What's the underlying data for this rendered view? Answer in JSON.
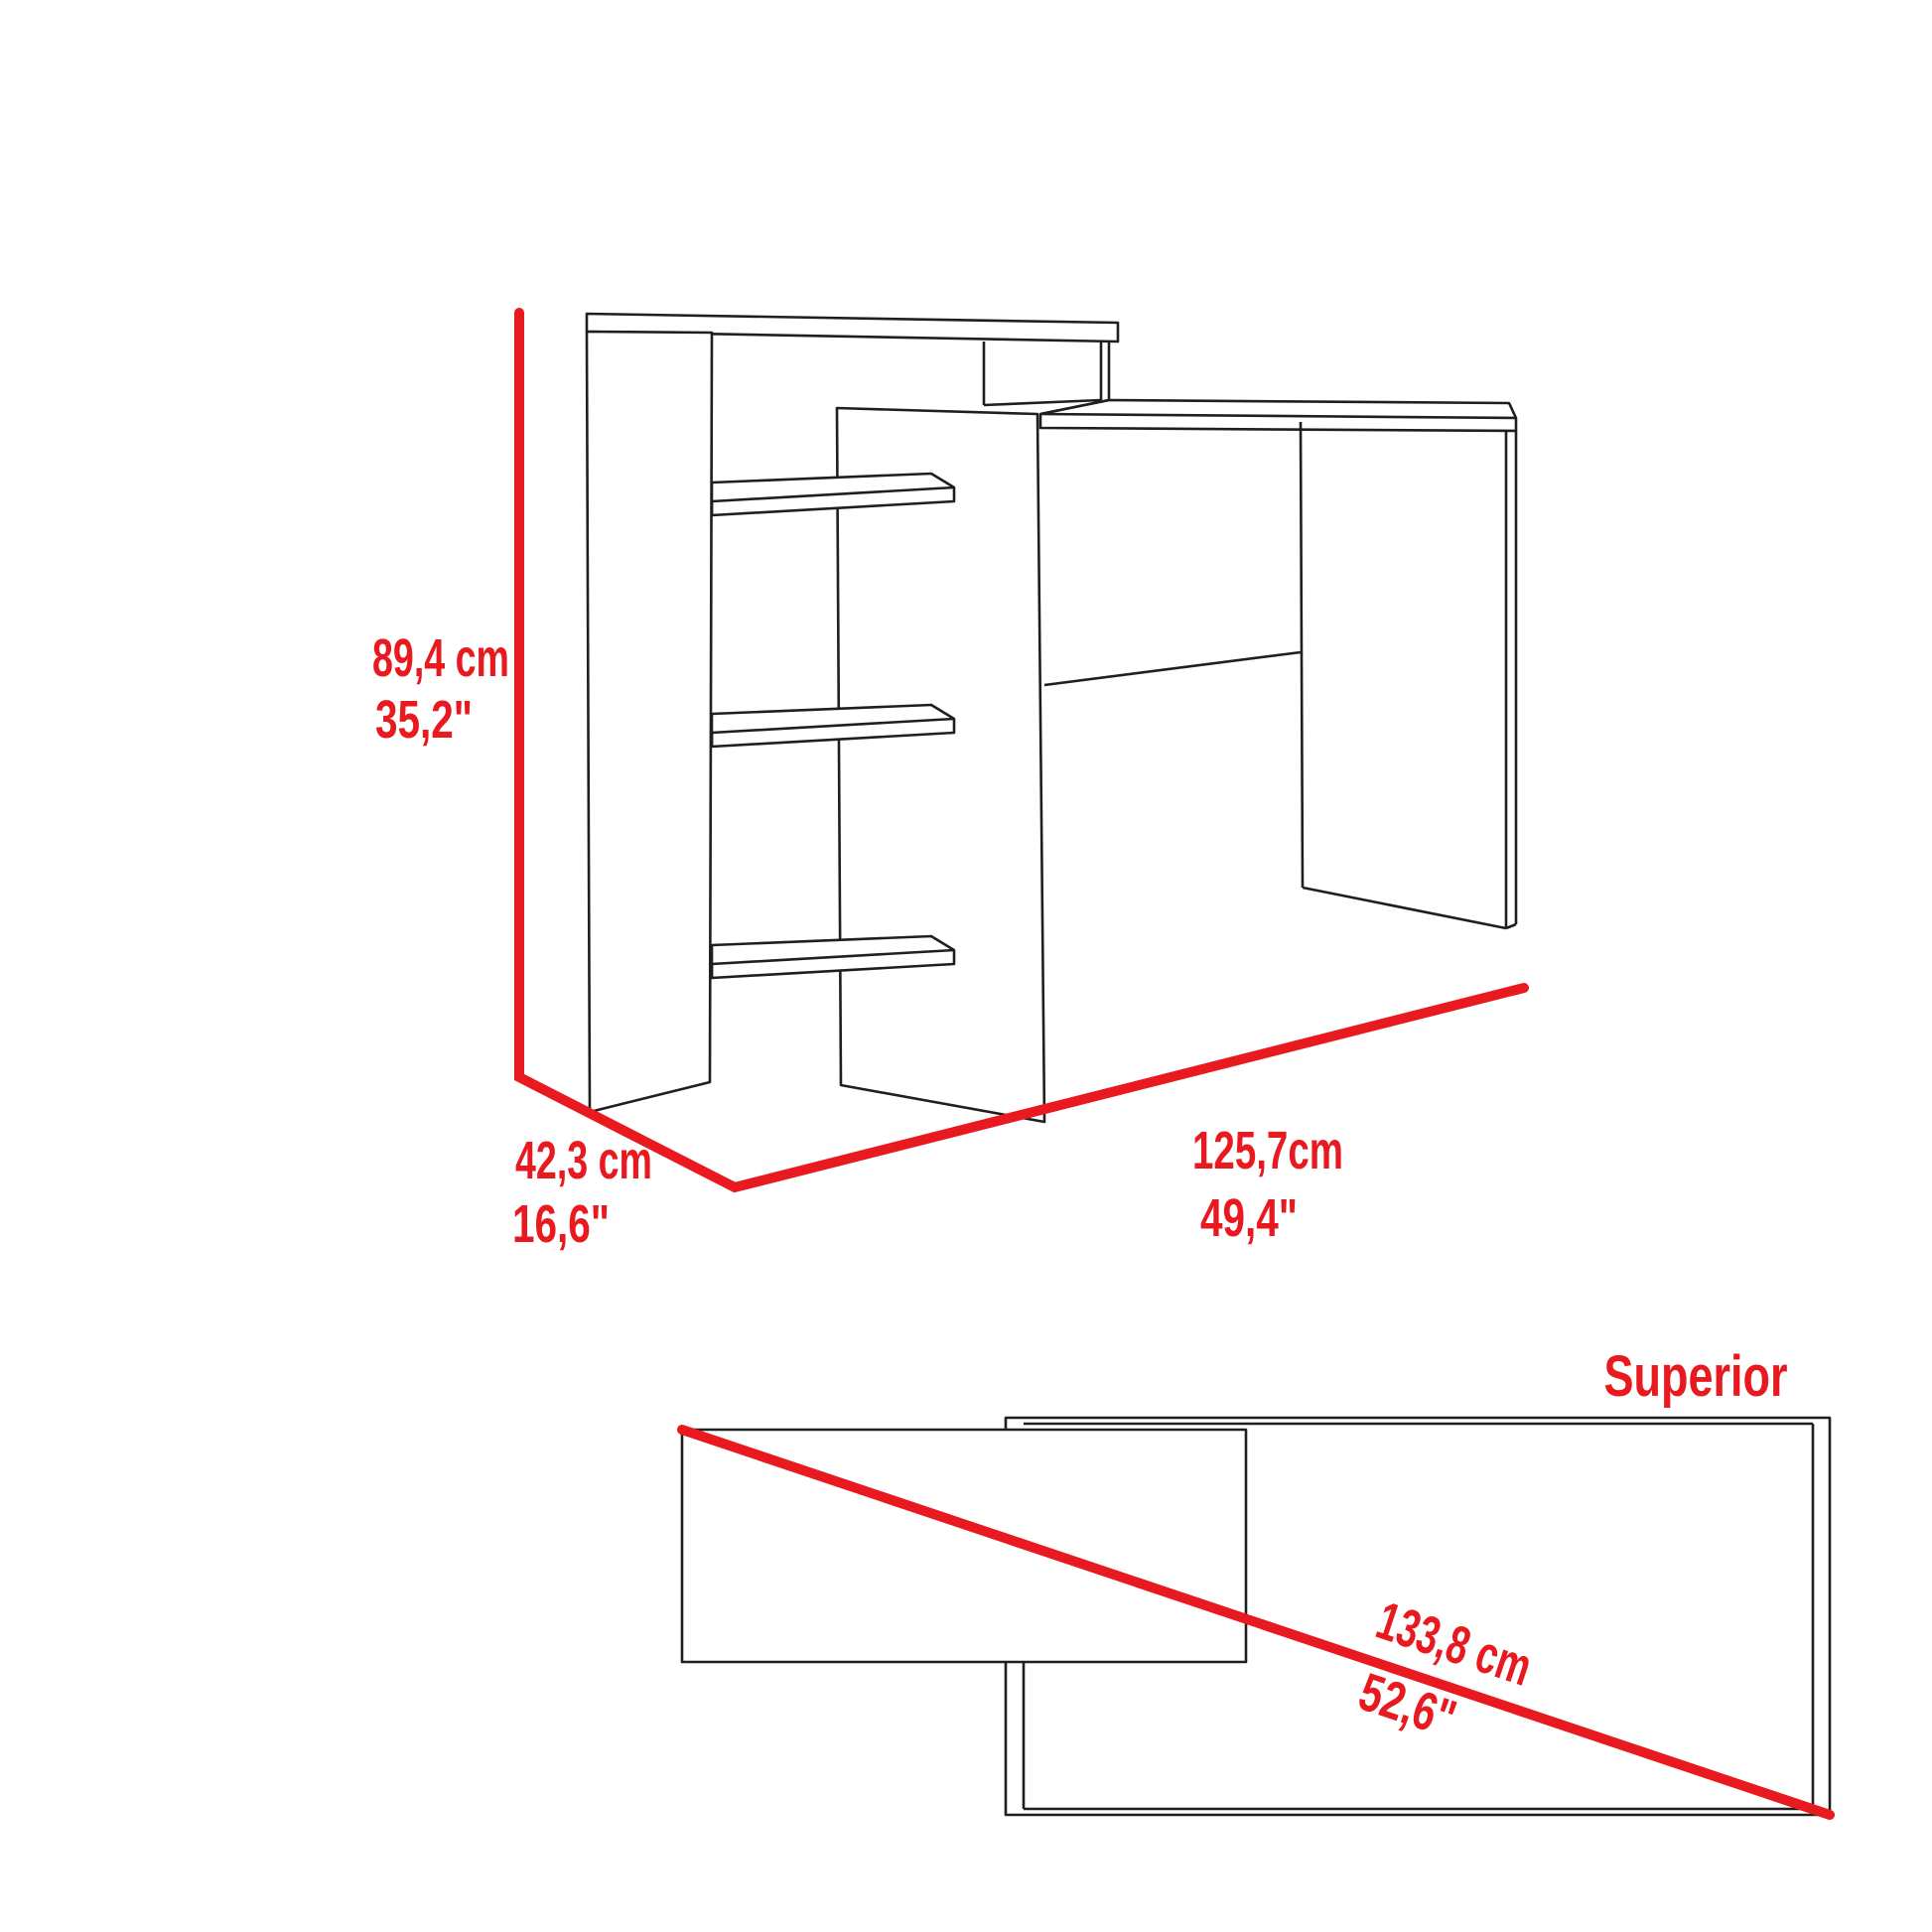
{
  "diagram": {
    "kind": "furniture-dimension-diagram",
    "colors": {
      "dimension_red": "#e8191f",
      "outline_black": "#1f1f1f",
      "background": "#ffffff"
    },
    "perspective_view": {
      "height_cm": "89,4 cm",
      "height_in": "35,2\"",
      "depth_cm": "42,3 cm",
      "depth_in": "16,6\"",
      "width_cm": "125,7cm",
      "width_in": "49,4\""
    },
    "top_view": {
      "title": "Superior",
      "diagonal_cm": "133,8 cm",
      "diagonal_in": "52,6\""
    }
  }
}
